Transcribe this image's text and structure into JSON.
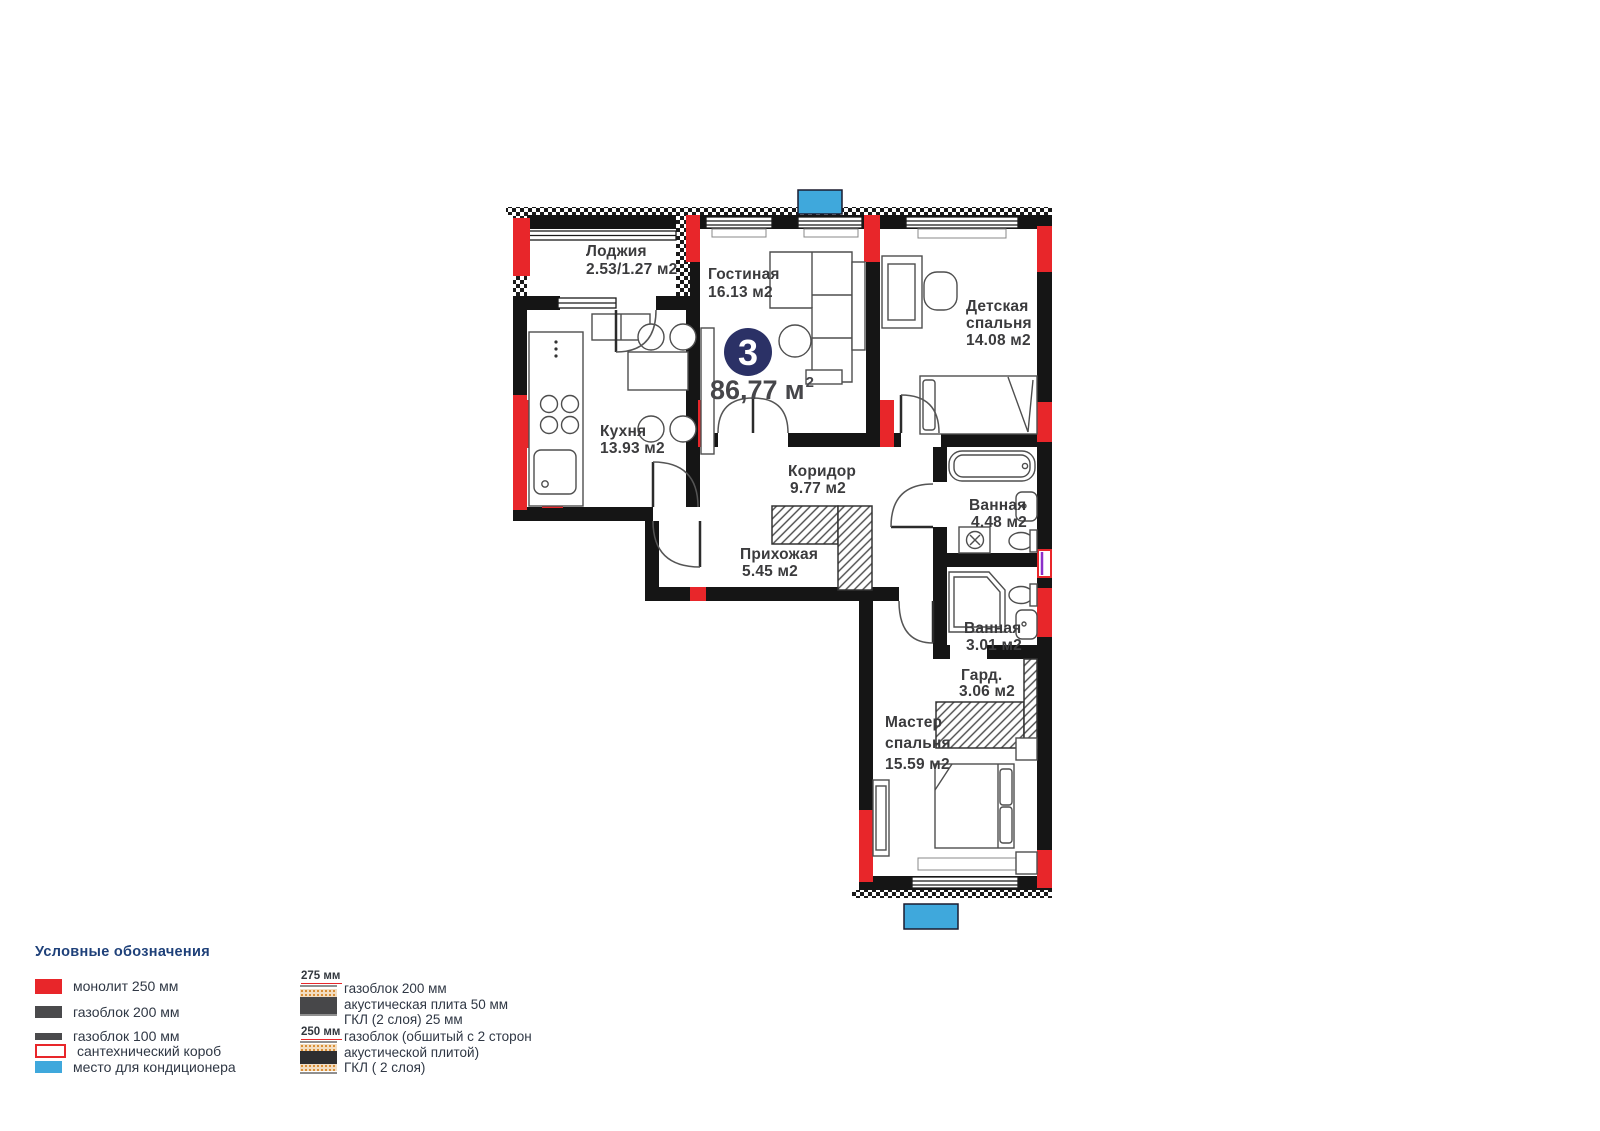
{
  "plan": {
    "number_badge": "3",
    "total_area": "86,77",
    "area_unit": "м",
    "area_sup": "2",
    "rooms": [
      {
        "name": "loggia",
        "lines": [
          "Лоджия",
          "2.53/1.27 м2"
        ]
      },
      {
        "name": "living-room",
        "lines": [
          "Гостиная",
          "16.13 м2"
        ]
      },
      {
        "name": "kids-bedroom",
        "lines": [
          "Детская",
          "спальня",
          "14.08 м2"
        ]
      },
      {
        "name": "kitchen",
        "lines": [
          "Кухня",
          "13.93 м2"
        ]
      },
      {
        "name": "corridor",
        "lines": [
          "Коридор",
          "9.77 м2"
        ]
      },
      {
        "name": "bathroom-1",
        "lines": [
          "Ванная",
          "4.48 м2"
        ]
      },
      {
        "name": "hallway",
        "lines": [
          "Прихожая",
          "5.45 м2"
        ]
      },
      {
        "name": "bathroom-2",
        "lines": [
          "Ванная",
          "3.01 м2"
        ]
      },
      {
        "name": "wardrobe",
        "lines": [
          "Гард.",
          "3.06 м2"
        ]
      },
      {
        "name": "master-bedroom",
        "lines": [
          "Мастер",
          "спальня",
          "15.59 м2"
        ]
      }
    ]
  },
  "legend": {
    "title": "Условные обозначения",
    "items": [
      {
        "label": "монолит 250 мм",
        "color": "#e8262a"
      },
      {
        "label": "газоблок 200 мм",
        "color": "#4a4a4c"
      },
      {
        "label": "газоблок 100 мм",
        "color": "#4a4a4c"
      },
      {
        "label": "сантехнический короб",
        "color": "#e8262a"
      },
      {
        "label": "место для кондиционера",
        "color": "#3fa8dc"
      }
    ],
    "wall_types": [
      {
        "dim": "275 мм",
        "lines": [
          "газоблок 200 мм",
          "акустическая плита 50 мм",
          "ГКЛ (2 слоя) 25 мм"
        ]
      },
      {
        "dim": "250 мм",
        "lines": [
          "газоблок (обшитый с 2 сторон",
          "акустической плитой)",
          "ГКЛ ( 2 слоя)"
        ]
      }
    ]
  },
  "colors": {
    "monolith_red": "#e8262a",
    "ac_blue": "#3fa8dc",
    "badge_navy": "#2b3166",
    "legend_title_blue": "#1e4079",
    "plumbing_purple": "#8b2fc9"
  }
}
